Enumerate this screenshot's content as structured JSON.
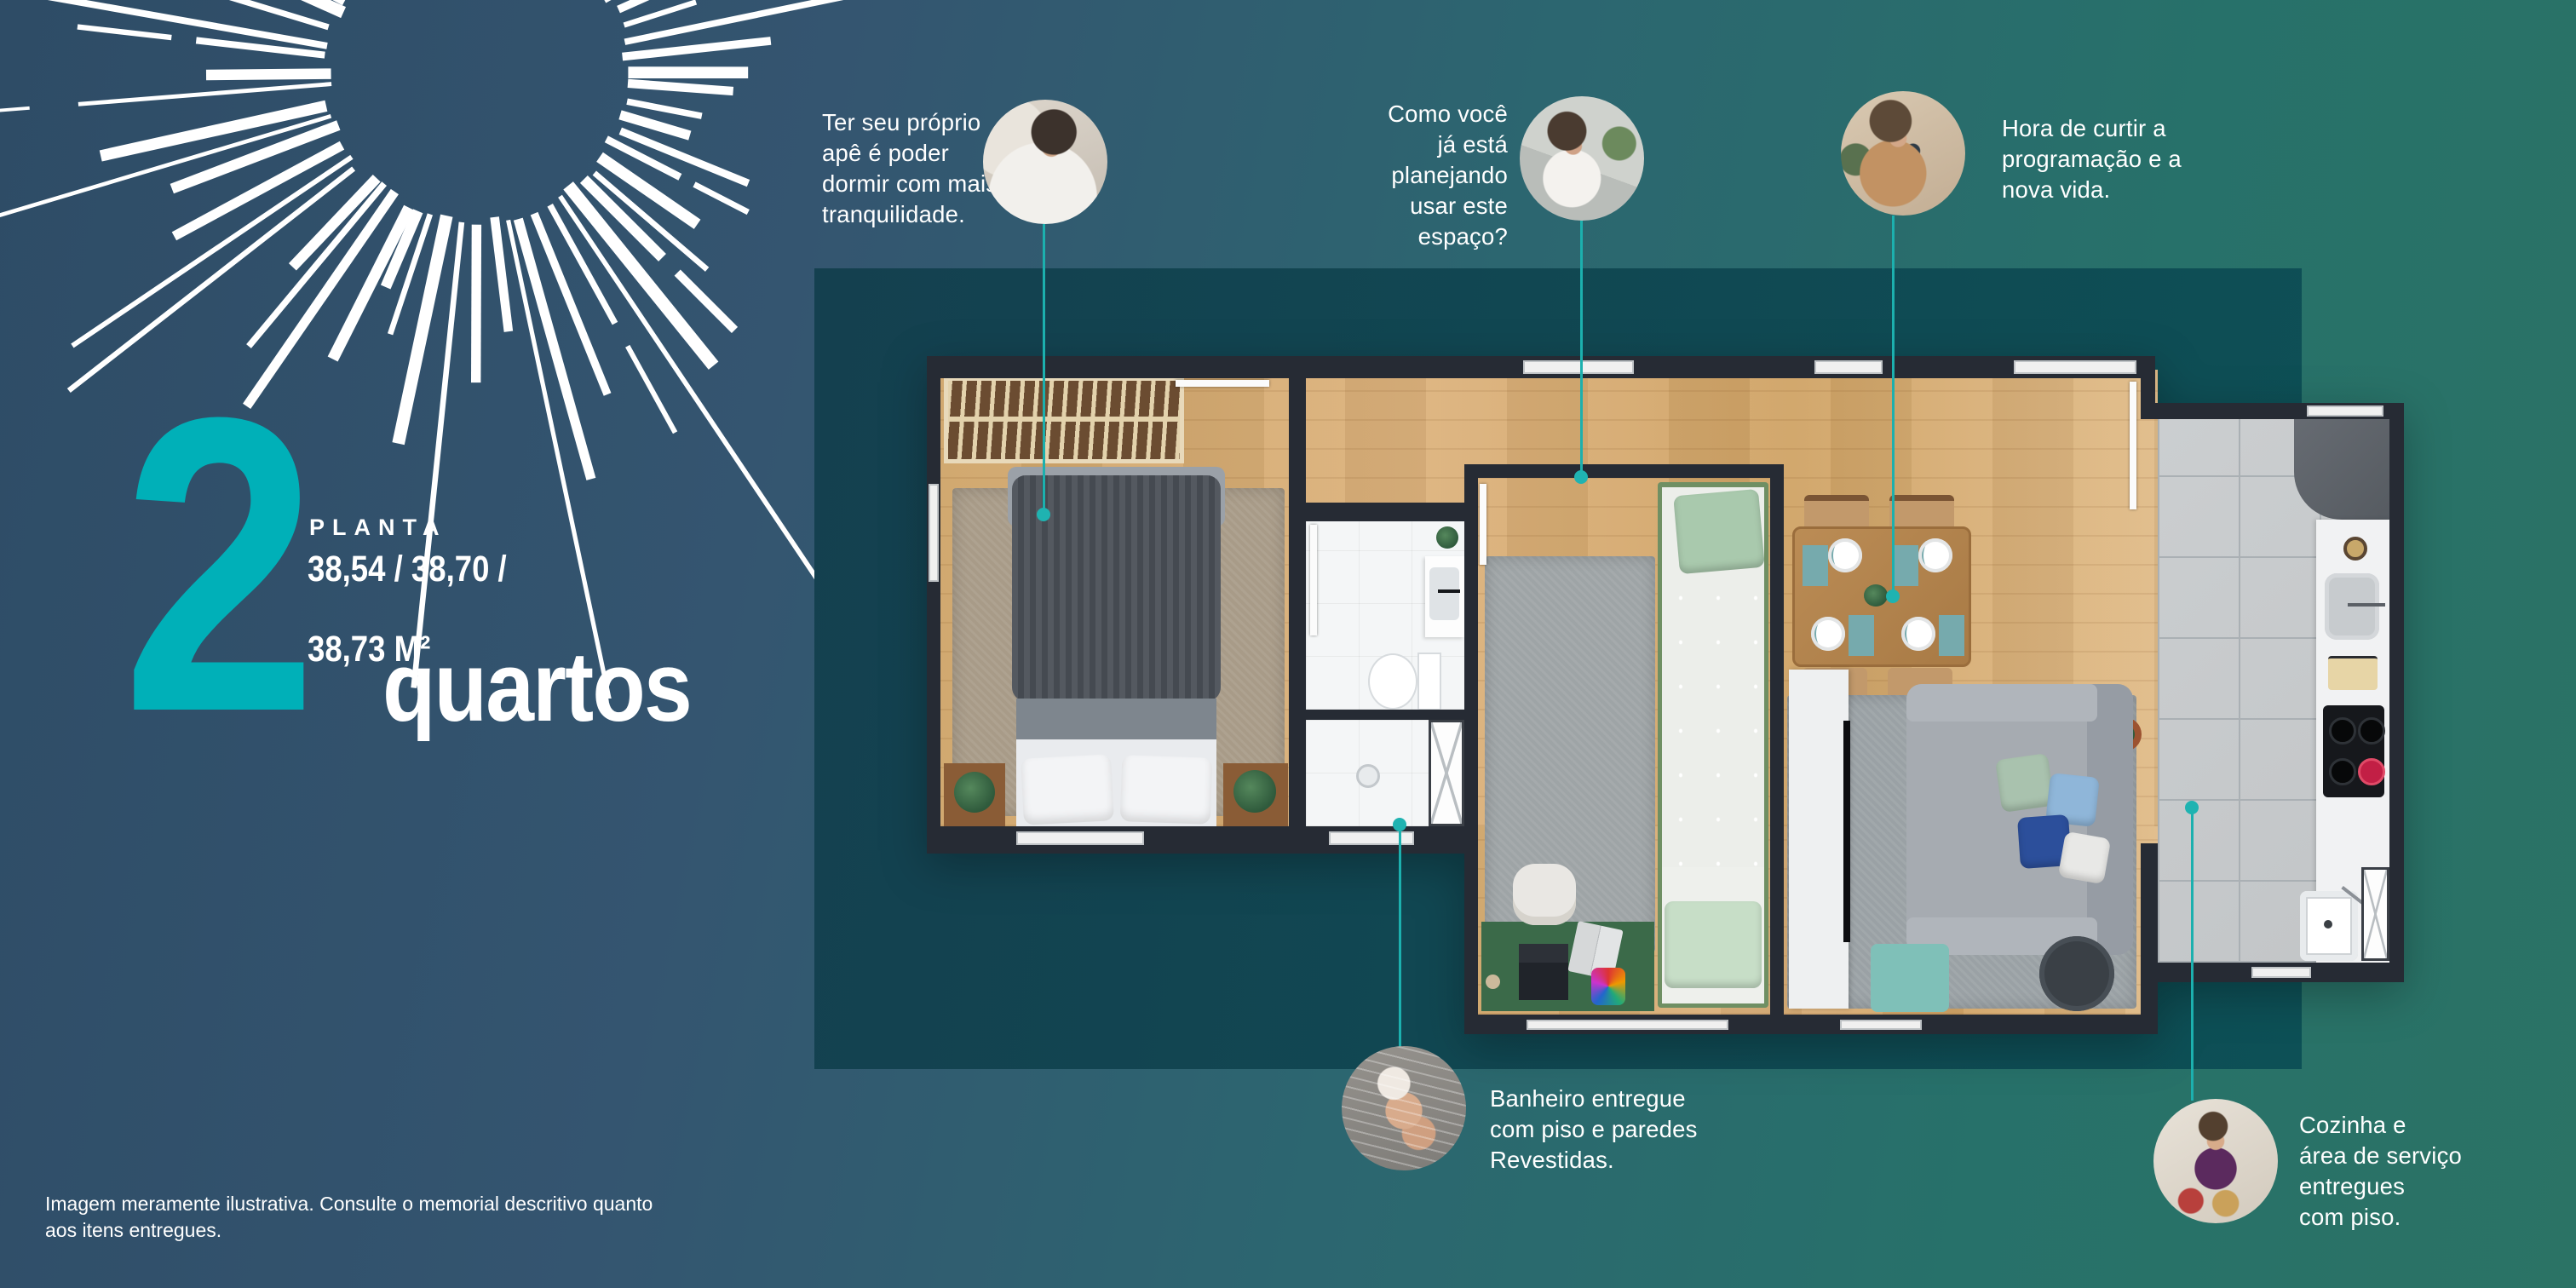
{
  "page": {
    "background_gradient": [
      "#2e4c66",
      "#345570",
      "#2c6670",
      "#27716a",
      "#2b7365"
    ],
    "panel_color": "#0d5056",
    "accent_teal": "#00b0b8",
    "callout_line_color": "#1cb0ae"
  },
  "headline": {
    "number": "2",
    "planta_label": "PLANTA",
    "areas_line1": "38,54 / 38,70 /",
    "areas_line2": "38,73 M²",
    "rooms_word": "quartos"
  },
  "callouts": [
    {
      "id": "bedroom",
      "text": "Ter seu próprio\napê é poder\ndormir com mais\ntranquilidade.",
      "photo": "woman-sleeping"
    },
    {
      "id": "flex-space",
      "text": "Como você\njá está\nplanejando\nusar este\nespaço?",
      "photo": "woman-phone-laptop"
    },
    {
      "id": "living",
      "text": "Hora de curtir a\nprogramação e a\nnova vida.",
      "photo": "woman-relaxing-sofa"
    },
    {
      "id": "bathroom",
      "text": "Banheiro entregue\ncom piso e paredes\nRevestidas.",
      "photo": "woman-shower"
    },
    {
      "id": "kitchen",
      "text": "Cozinha e\nárea de serviço\nentregues\ncom piso.",
      "photo": "woman-cooking"
    }
  ],
  "disclaimer": {
    "line1": "Imagem meramente ilustrativa. Consulte o memorial descritivo quanto",
    "line2": "aos itens entregues."
  },
  "floorplan": {
    "rooms": [
      "quarto-1",
      "banheiro",
      "quarto-2",
      "sala-de-jantar",
      "sala-de-estar",
      "cozinha",
      "area-de-servico"
    ]
  }
}
